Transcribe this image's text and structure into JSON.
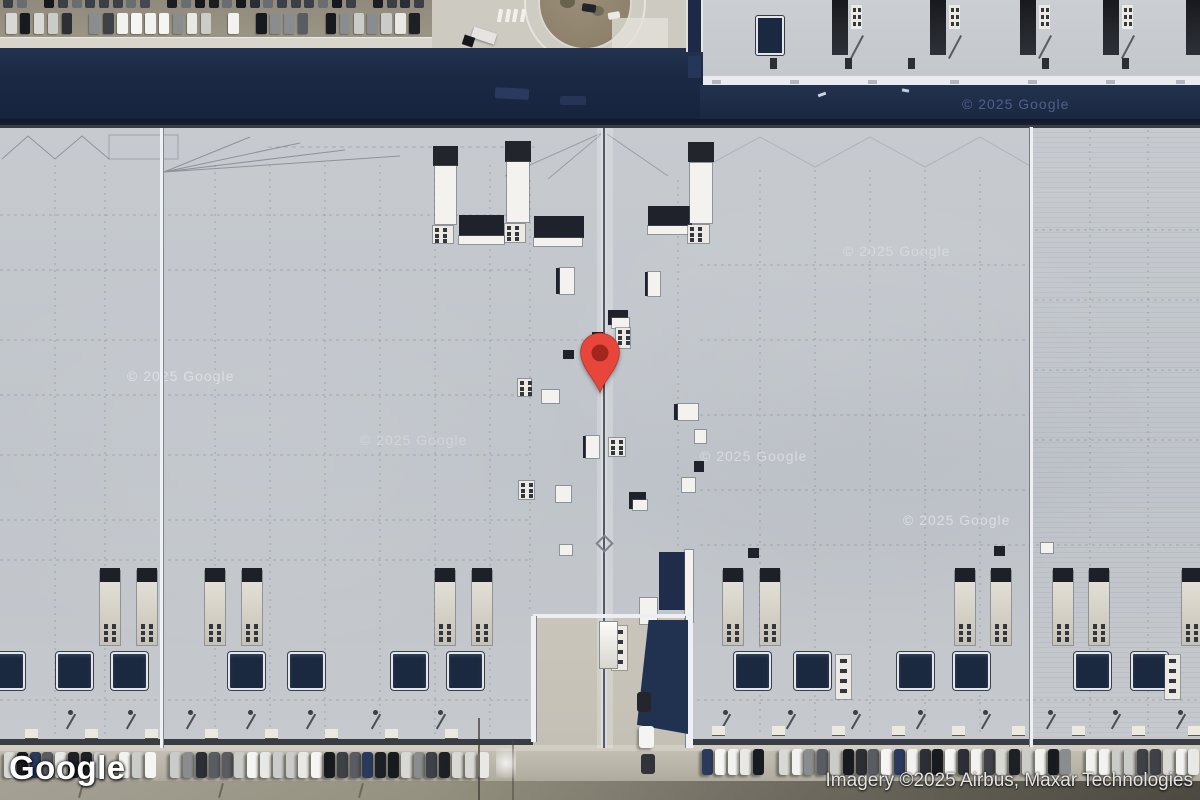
{
  "map": {
    "type": "satellite",
    "logo_text": "Google",
    "attribution_text": "Imagery ©2025 Airbus, Maxar Technologies",
    "watermark_text": "© 2025 Google"
  },
  "watermarks": [
    {
      "x": 127,
      "y": 368,
      "variant": "roof",
      "opacity": 0.42
    },
    {
      "x": 360,
      "y": 432,
      "variant": "roof",
      "opacity": 0.26
    },
    {
      "x": 843,
      "y": 243,
      "variant": "roof",
      "opacity": 0.3
    },
    {
      "x": 700,
      "y": 448,
      "variant": "roof",
      "opacity": 0.4
    },
    {
      "x": 903,
      "y": 512,
      "variant": "roof",
      "opacity": 0.45
    },
    {
      "x": 962,
      "y": 96,
      "variant": "navy",
      "opacity": 0.75
    }
  ],
  "marker": {
    "body_color": "#E8463B",
    "dot_color": "#A3261E",
    "tip_x": 600,
    "tip_y": 398
  },
  "colors": {
    "roof": "#c4c8cd",
    "road_navy": "#1b2944",
    "dock_square": "#1b2940",
    "trailer_body": "#ddd9cf",
    "trailer_cap": "#22252b",
    "ground": "#bab6aa",
    "watermark_roof": "#ffffff",
    "watermark_navy": "#5d72a0"
  }
}
